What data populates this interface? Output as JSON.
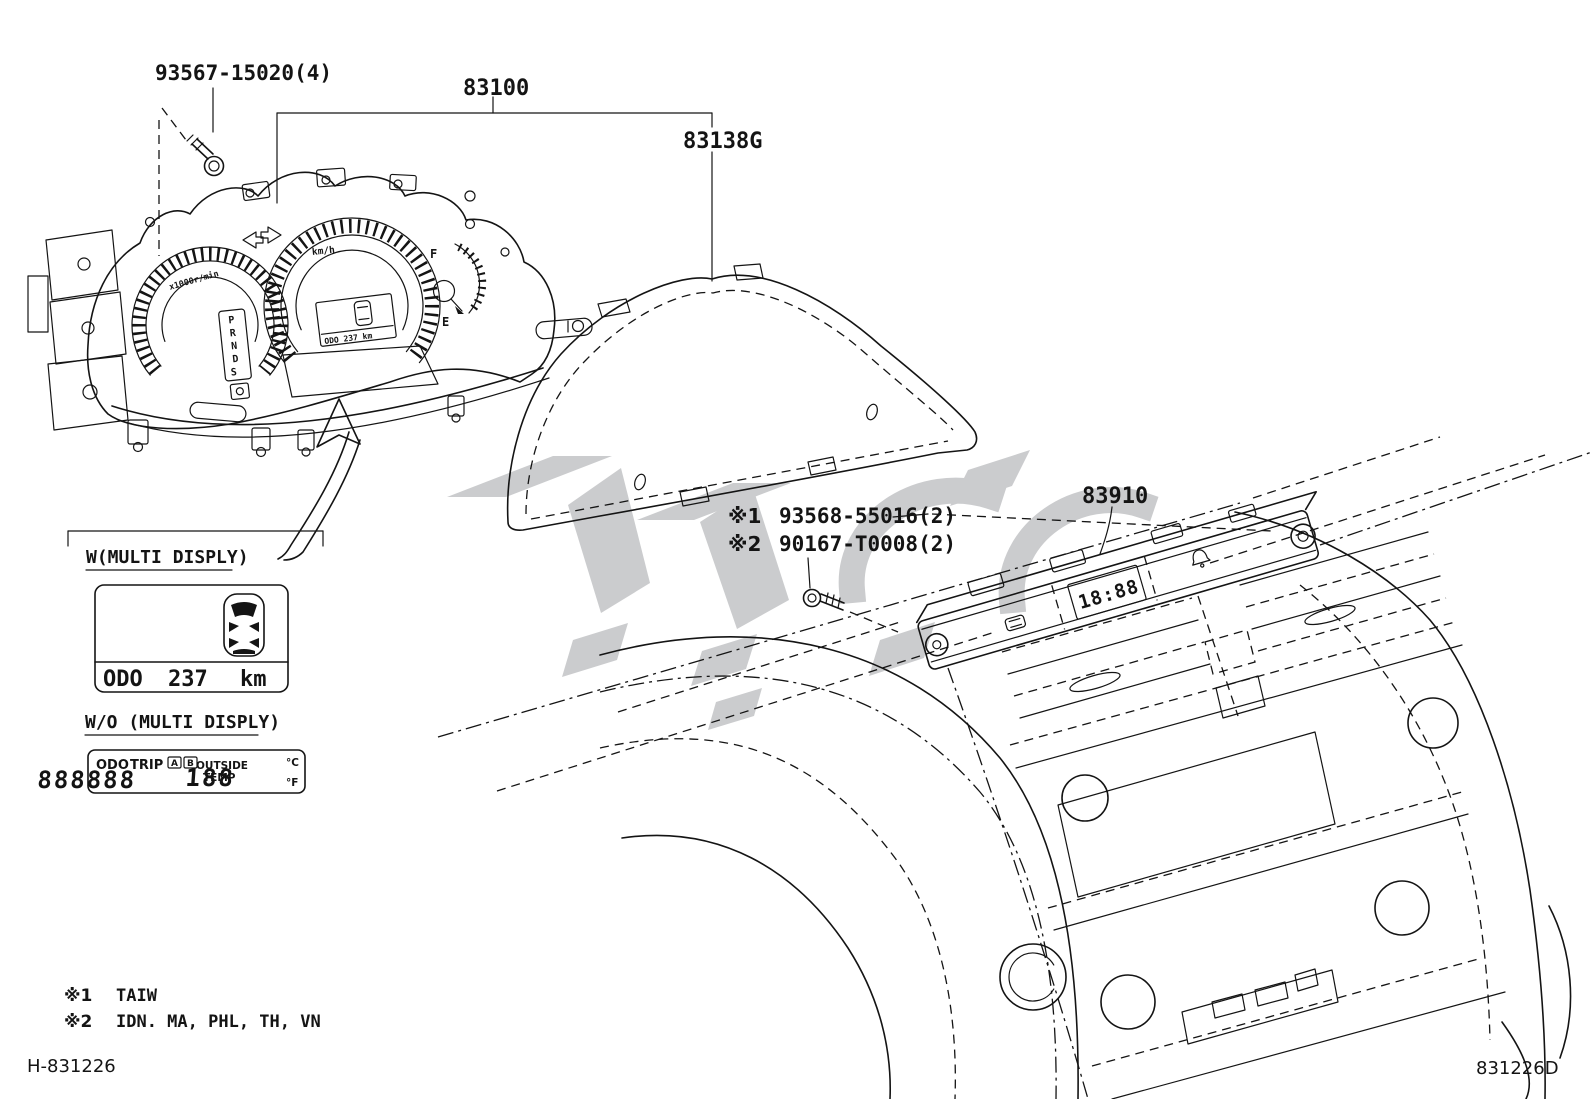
{
  "diagram": {
    "parts": {
      "screw_label": "93567-15020(4)",
      "meter_assy": "83100",
      "meter_glass": "83138G",
      "center_display": "83910",
      "note1_mark": "※1",
      "note1_num": "93568-55016(2)",
      "note2_mark": "※2",
      "note2_num": "90167-T0008(2)"
    },
    "cluster": {
      "speed_unit": "km/h",
      "tach_unit": "x1000r/min",
      "gear": [
        "P",
        "R",
        "N",
        "D",
        "S"
      ],
      "fuel_full": "F",
      "fuel_empty": "E",
      "odo_mini": "ODO 237 km"
    },
    "center_display": {
      "clock": "18:88"
    },
    "multi_display": {
      "title": "W(MULTI DISPLY)",
      "odo_label": "ODO",
      "odo_value": "237",
      "odo_unit": "km"
    },
    "wo_display": {
      "title": "W/O (MULTI DISPLY)",
      "odo": "ODO",
      "trip": "TRIP",
      "trip_a": "A",
      "trip_b": "B",
      "digits": "888888",
      "outside": "OUTSIDE",
      "temp": "TEMP",
      "value": "188",
      "deg_c": "°C",
      "deg_f": "°F"
    },
    "footnotes": {
      "f1_mark": "※1",
      "f1_text": "TAIW",
      "f2_mark": "※2",
      "f2_text": "IDN. MA, PHL, TH, VN"
    },
    "footer": {
      "left": "H-831226",
      "right": "831226D"
    }
  }
}
